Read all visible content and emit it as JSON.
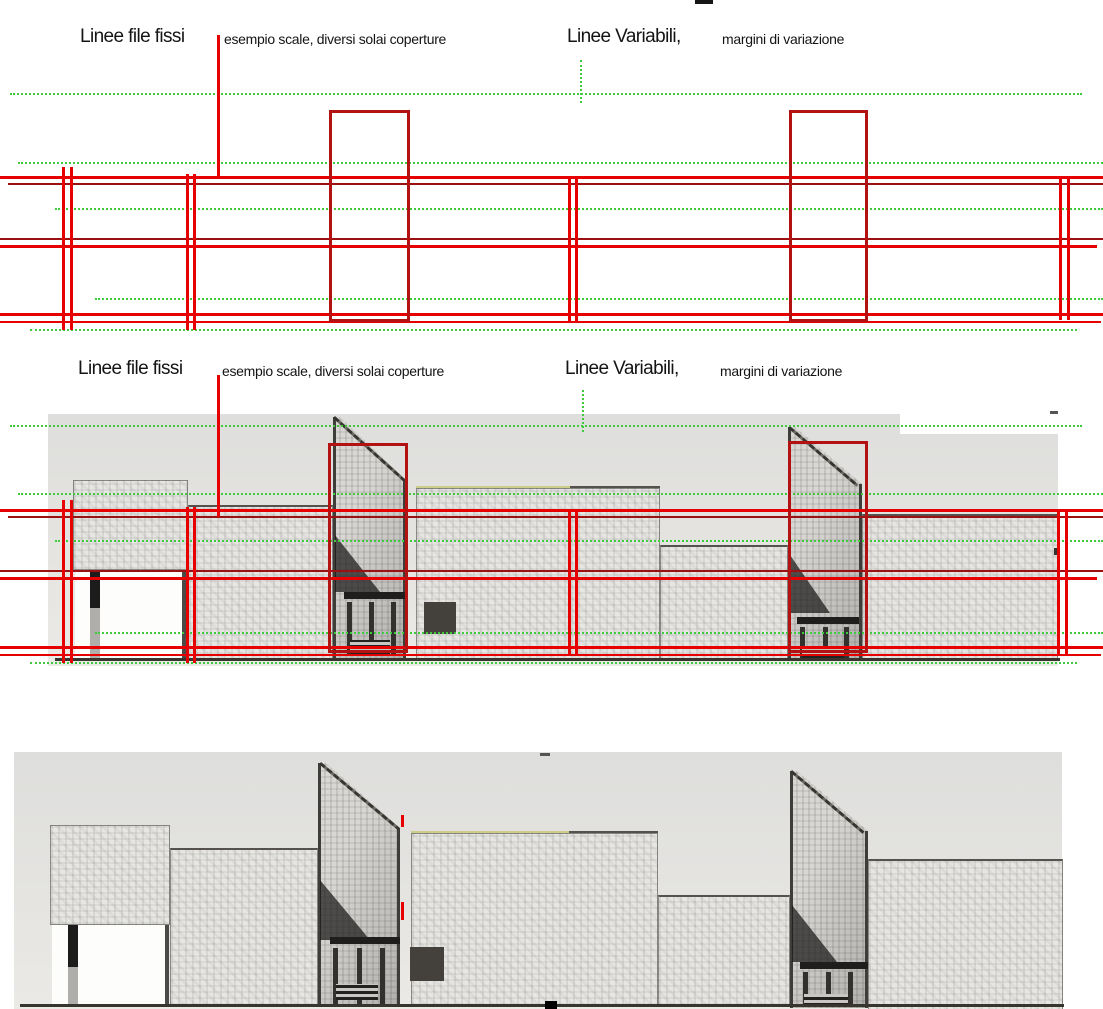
{
  "annotations": {
    "fixed": {
      "title": "Linee file fissi",
      "subtitle": "esempio scale, diversi solai coperture"
    },
    "variable": {
      "title": "Linee Variabili,",
      "subtitle": "margini di variazione"
    }
  },
  "colors": {
    "fixed_line_red": "#e60000",
    "fixed_line_dark_red": "#9b1010",
    "variation_rect_red": "#b31212",
    "variable_line_green": "#3ecb3e",
    "roof_highlight_yellow": "#cdcd8a",
    "sketch_ink": "#3f3d3a",
    "paper": "#ffffff"
  }
}
